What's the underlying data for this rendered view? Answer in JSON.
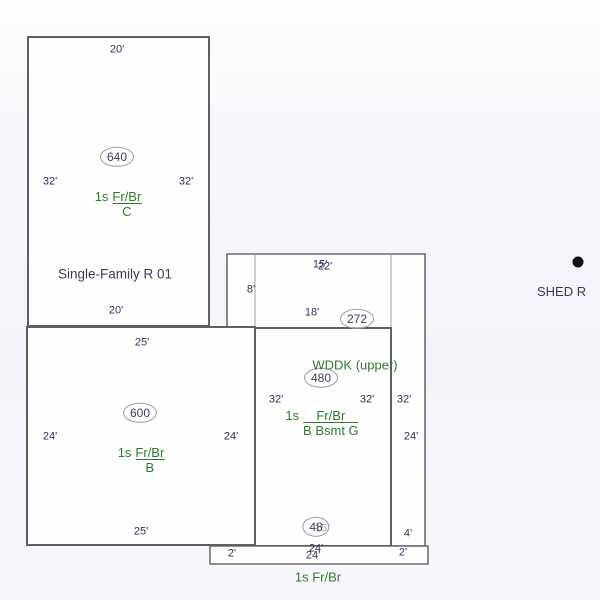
{
  "sketch": {
    "main640": {
      "area": "640",
      "dim_top": "20'",
      "dim_left": "32'",
      "dim_right": "32'",
      "dim_bottom": "20'",
      "story_prefix": "1s",
      "wall_code": "Fr/Br",
      "basement_code": "C",
      "building_name": "Single-Family R 01"
    },
    "add600": {
      "area": "600",
      "dim_top": "25'",
      "dim_left": "24'",
      "dim_right": "24'",
      "dim_bottom": "25'",
      "story_prefix": "1s",
      "wall_code": "Fr/Br",
      "basement_code": "B"
    },
    "add480": {
      "area": "480",
      "dim_top": "15'",
      "dim_left": "32'",
      "dim_right": "32'",
      "dim_bottom": "15'",
      "story_prefix": "1s",
      "wall_code": "Fr/Br",
      "basement_code": "B Bsmt G"
    },
    "deck272": {
      "area": "272",
      "label": "WDDK (upper)",
      "dim_top": "22'",
      "dim_left": "8'",
      "dim_inner_bottom": "18'",
      "dim_outer_right": "32'",
      "dim_inner_right": "24'",
      "dim_bottom_right": "4'"
    },
    "porch48": {
      "area": "48",
      "dim_top": "24'",
      "dim_bottom": "24'",
      "dim_left": "2'",
      "dim_right": "2'",
      "label": "1s Fr/Br"
    },
    "shed": {
      "label": "SHED R"
    }
  },
  "colors": {
    "outline": "#5f5f5f",
    "shared_edge": "#b8b8b8",
    "dimension_text": "#2f2f58",
    "code_text_green": "#2e7b2e",
    "area_text": "#413d60",
    "ellipse_border": "#9a9aa8",
    "building_fill": "#fefeff",
    "shed_dot": "#111111"
  }
}
